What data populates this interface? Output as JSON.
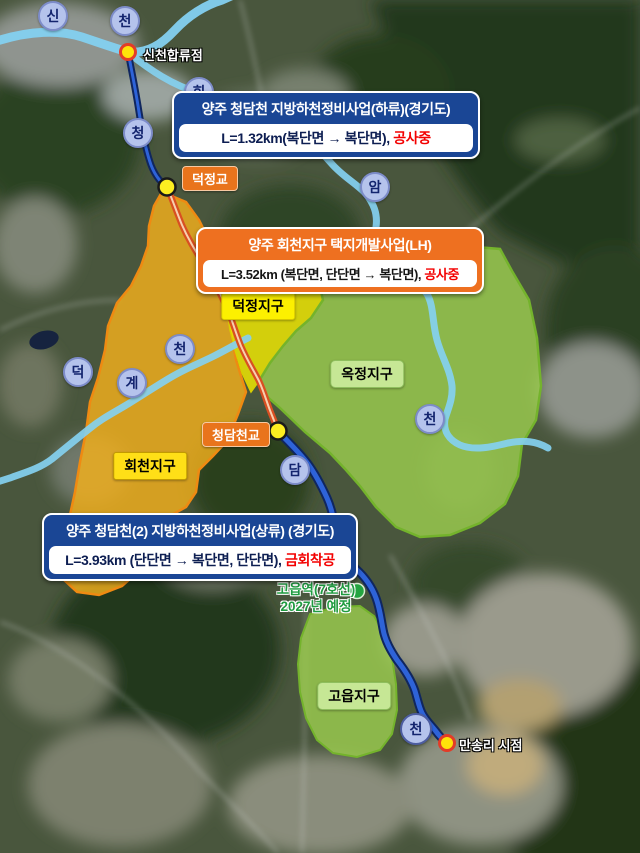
{
  "projects": [
    {
      "title": "양주 청담천 지방하천정비사업(하류)(경기도)",
      "length": "L=1.32km(복단면 → 복단면), ",
      "status": "공사중"
    },
    {
      "title": "양주 회천지구 택지개발사업(LH)",
      "length": "L=3.52km (복단면, 단단면 → 복단면), ",
      "status": "공사중"
    },
    {
      "title": "양주 청담천(2) 지방하천정비사업(상류) (경기도)",
      "length": "L=3.93km (단단면 → 복단면, 단단면), ",
      "status": "금회착공"
    }
  ],
  "districts": [
    {
      "name": "덕정지구"
    },
    {
      "name": "옥정지구"
    },
    {
      "name": "회천지구"
    },
    {
      "name": "고읍지구"
    }
  ],
  "bridges": [
    {
      "name": "덕정교"
    },
    {
      "name": "청담천교"
    }
  ],
  "points": {
    "confluence": "신천합류점",
    "start": "만송리 시점",
    "station_line1": "고읍역(7호선)",
    "station_line2": "2027년 예정"
  },
  "badges": [
    "신",
    "천",
    "회",
    "청",
    "암",
    "천",
    "덕",
    "계",
    "천",
    "담",
    "천"
  ],
  "colors": {
    "project_blue": "#1a4695",
    "project_orange": "#ee7020",
    "status_red": "#f30000",
    "zone_gold": "#f3b01c",
    "zone_yellow": "#f6ee00",
    "zone_green": "#9ed04f",
    "river_blue": "#2e63d8",
    "stream_lightblue": "#84d0f0",
    "construction_orange": "#d84f22",
    "marker_yellow": "#ffe20a",
    "station_green": "#23a440"
  }
}
